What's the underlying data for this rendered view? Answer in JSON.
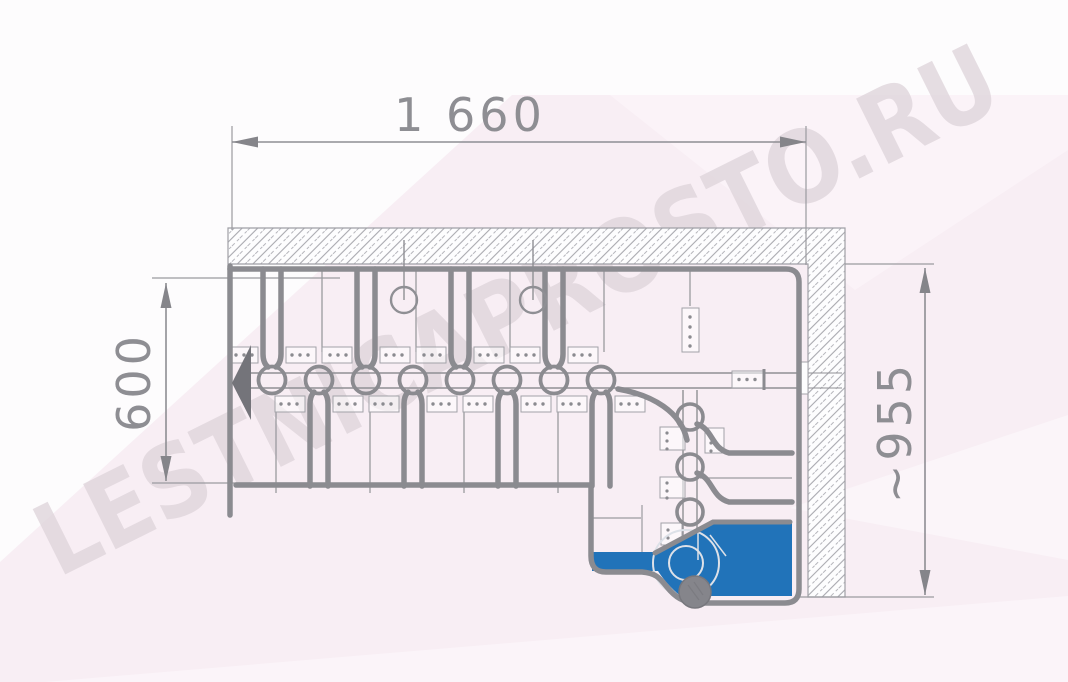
{
  "drawing": {
    "watermark": "LESTNICAPROSTO.RU",
    "dimensions": {
      "overall_length": "1 660",
      "flight_width": "600",
      "turn_extent": "~955"
    },
    "stair": {
      "straight_modules": 8,
      "winder_modules": 3,
      "first_step_highlighted": true
    },
    "colors": {
      "line": "#8b8b90",
      "line_thin": "#9a9a9f",
      "line_dark": "#74747a",
      "accent_blue": "#2173b9",
      "post_gray": "#85858b",
      "hatch": "#a9a9af",
      "pink": "#f8eef4",
      "pink_light": "#fbf3f8",
      "watermark_gray": "#ded5db",
      "dim_text": "#8e8e93",
      "background": "#fdfcfd"
    }
  }
}
